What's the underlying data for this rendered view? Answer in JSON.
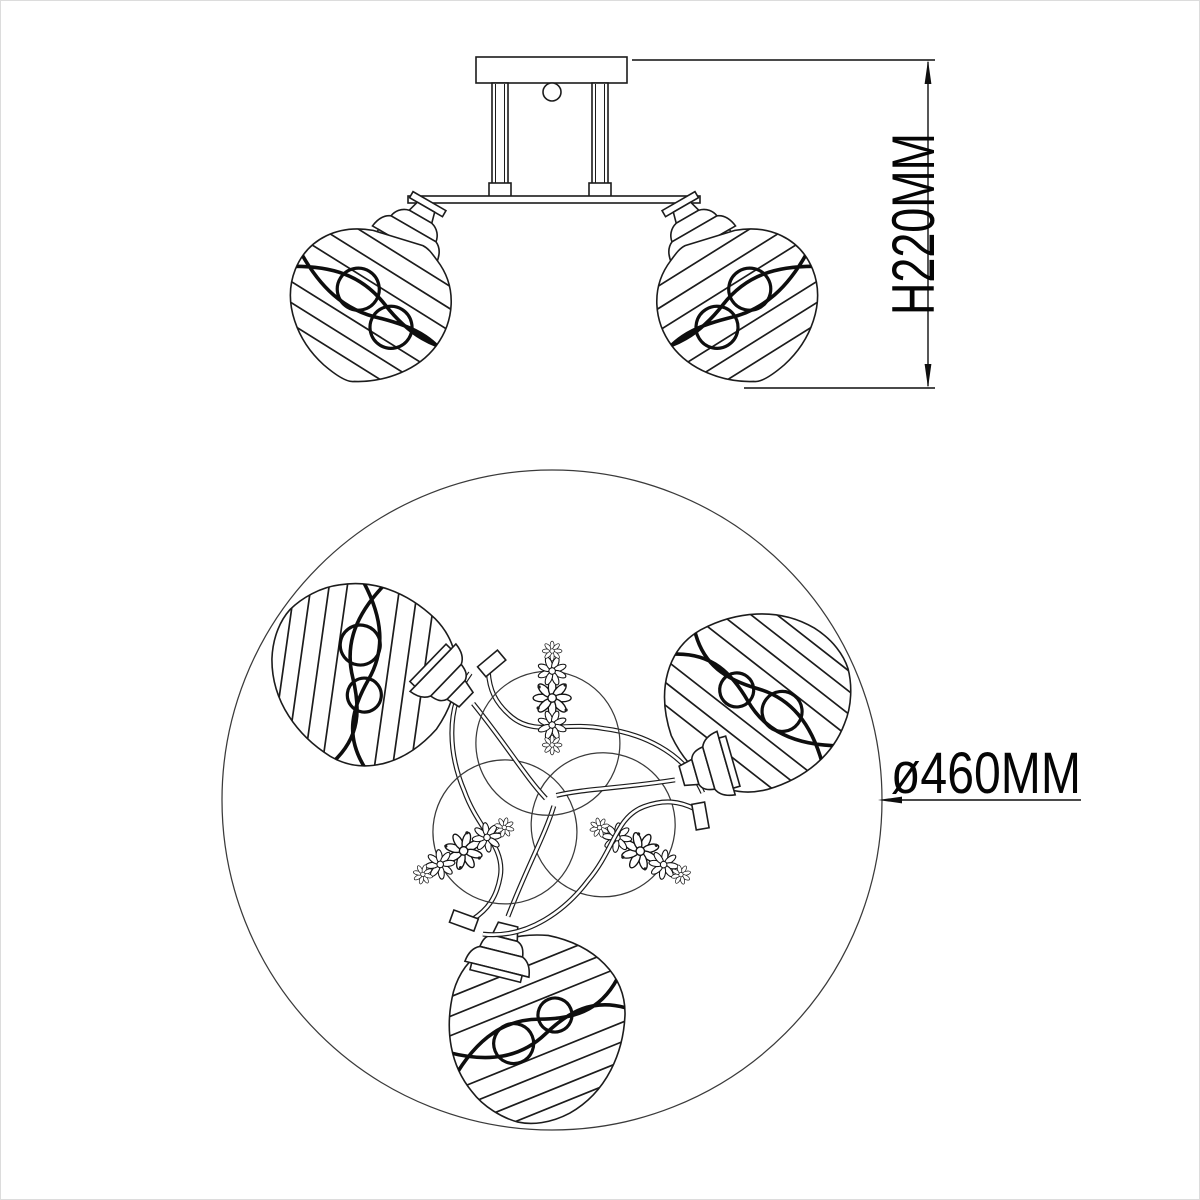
{
  "page": {
    "background_color": "#ffffff",
    "line_color": "#1c1c1c",
    "border_color": "#dcdcdc"
  },
  "drawing": {
    "kind": "product dimension line drawing",
    "subject": "ceiling chandelier with striped glass shades and filigree ornaments",
    "side_view_shades_visible": 2,
    "plan_view_shades_visible": 3
  },
  "dimensions": {
    "height_label": "H220MM",
    "diameter_label": "ø460MM"
  }
}
